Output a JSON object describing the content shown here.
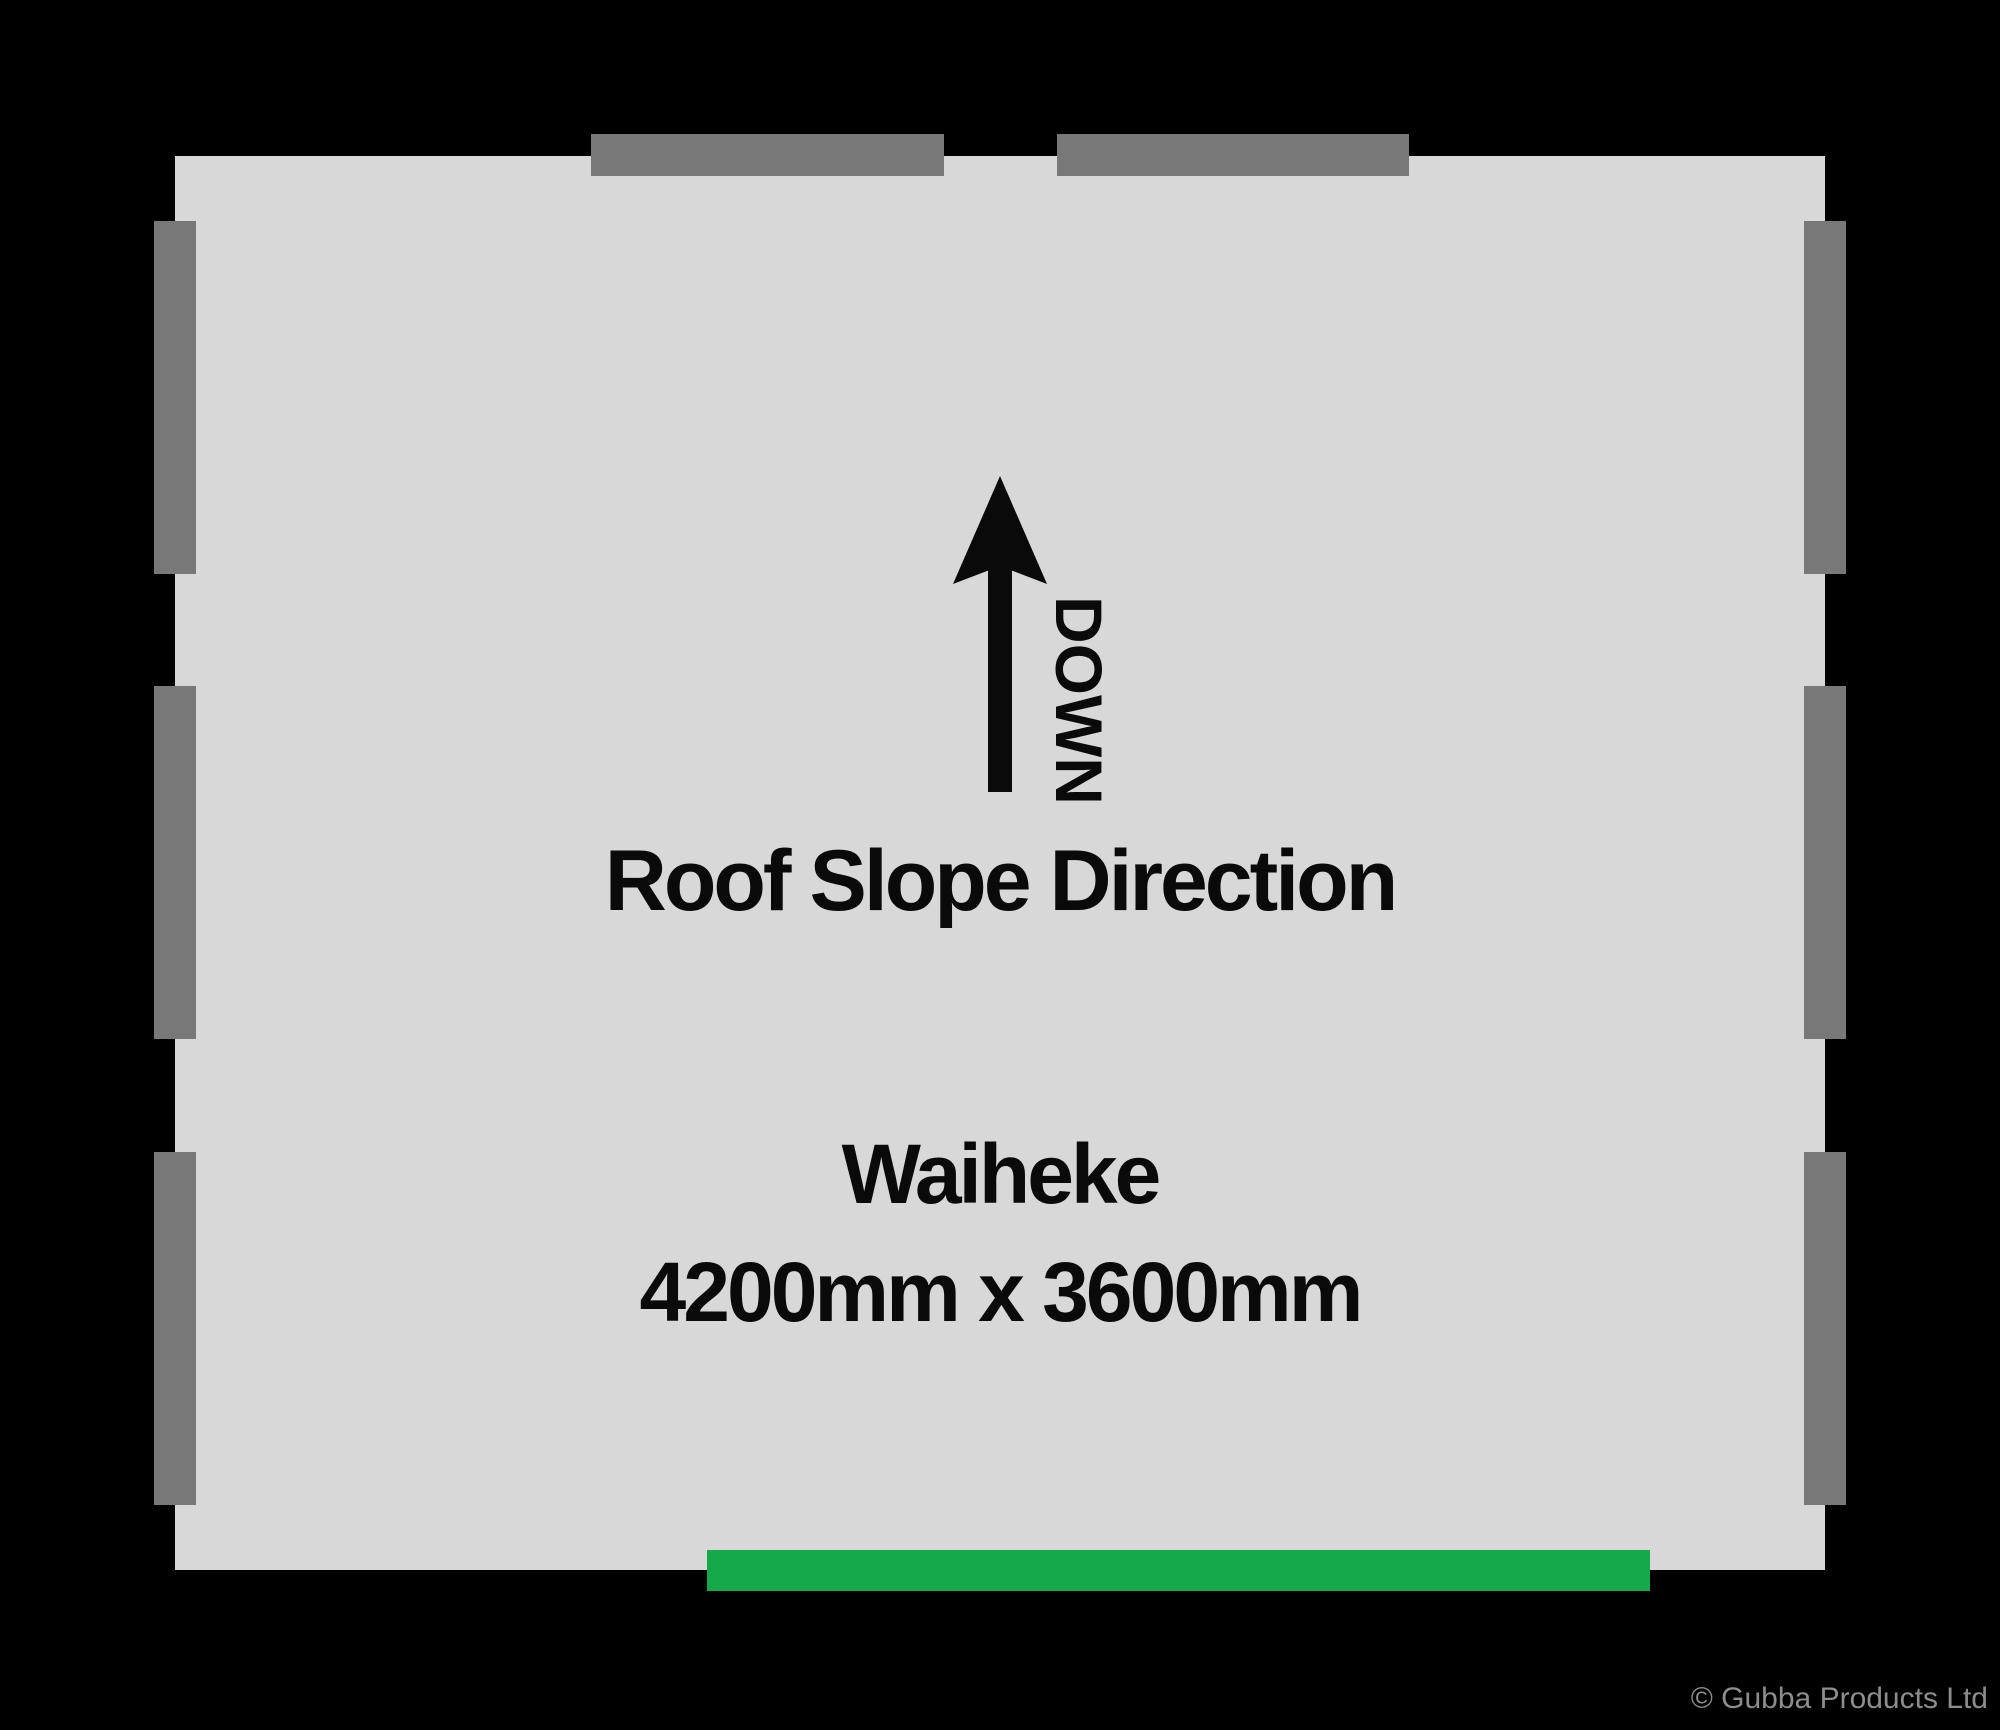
{
  "plan": {
    "name": "Waiheke",
    "dimensions_label": "4200mm x 3600mm",
    "roof_slope_label": "Roof Slope Direction",
    "roof_slope_arrow_label": "DOWN",
    "icons": {
      "roof_slope_arrow": "up-arrow-icon"
    },
    "colors": {
      "background": "#000000",
      "floor": "#d8d8d8",
      "window_marker": "#787878",
      "door_marker": "#16a94a",
      "text": "#0a0a0a",
      "copyright_text": "#8d8d8d"
    },
    "floor_rect": {
      "x": 175,
      "y": 156,
      "w": 1650,
      "h": 1414
    },
    "windows": [
      {
        "side": "top",
        "x": 591,
        "y": 134,
        "w": 353,
        "h": 42
      },
      {
        "side": "top",
        "x": 1057,
        "y": 134,
        "w": 352,
        "h": 42
      },
      {
        "side": "left",
        "x": 154,
        "y": 221,
        "w": 42,
        "h": 353
      },
      {
        "side": "left",
        "x": 154,
        "y": 686,
        "w": 42,
        "h": 353
      },
      {
        "side": "left",
        "x": 154,
        "y": 1152,
        "w": 42,
        "h": 353
      },
      {
        "side": "right",
        "x": 1804,
        "y": 221,
        "w": 42,
        "h": 353
      },
      {
        "side": "right",
        "x": 1804,
        "y": 686,
        "w": 42,
        "h": 353
      },
      {
        "side": "right",
        "x": 1804,
        "y": 1152,
        "w": 42,
        "h": 353
      }
    ],
    "door": {
      "side": "bottom",
      "x": 707,
      "y": 1550,
      "w": 943,
      "h": 41
    }
  },
  "footer": {
    "copyright": "© Gubba Products Ltd"
  }
}
